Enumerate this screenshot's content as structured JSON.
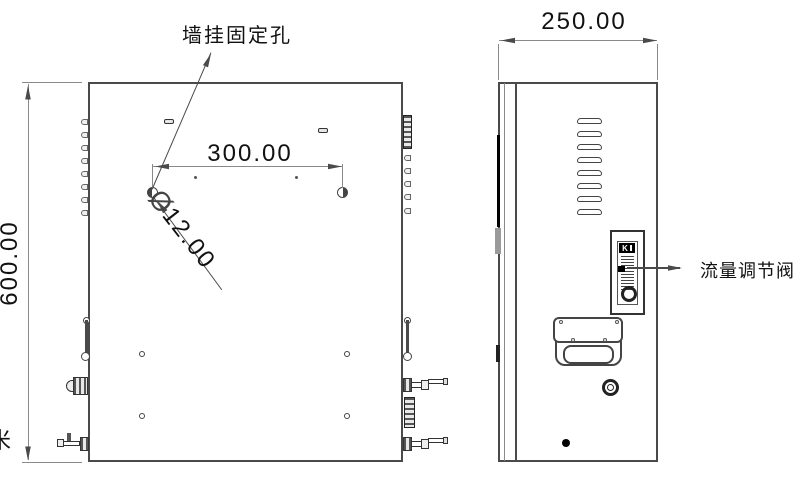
{
  "drawing": {
    "labels": {
      "wall_mount_hole": "墙挂固定孔",
      "flow_valve": "流量调节阀",
      "edge_clipped": "米"
    },
    "dimensions": {
      "front_height": "600.00",
      "hole_spacing": "300.00",
      "hole_diameter_symbol": "Ø",
      "hole_diameter": "12.00",
      "side_depth": "250.00"
    },
    "rotameter_badge": "K",
    "colors": {
      "line": "#4a4a4a",
      "background": "#ffffff"
    }
  }
}
